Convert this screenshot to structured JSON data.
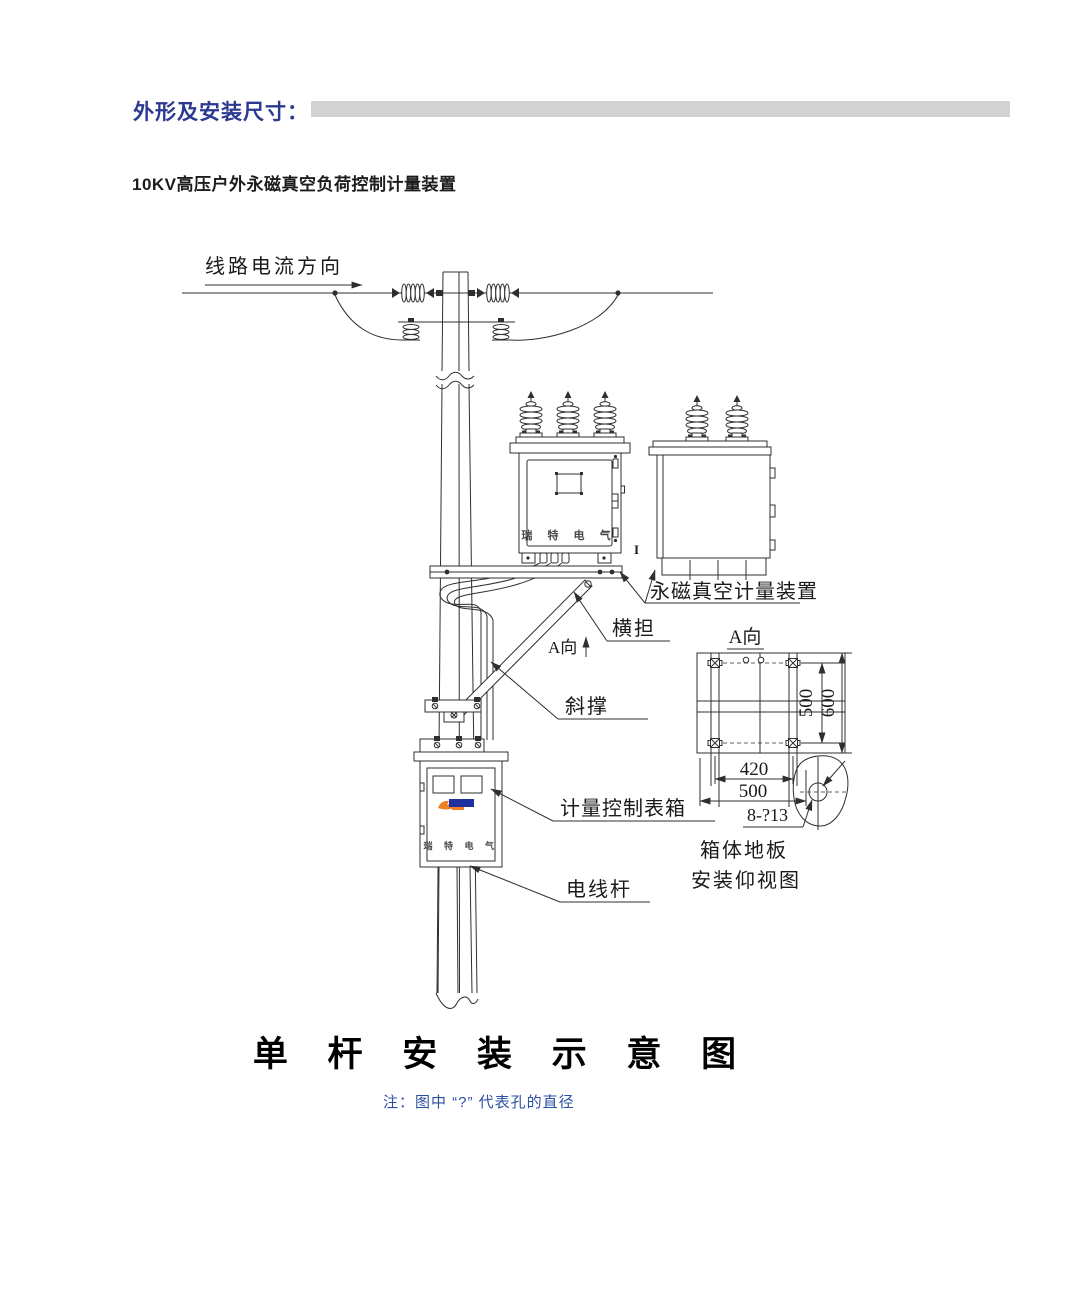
{
  "header": {
    "label": "外形及安装尺寸：",
    "bar_color": "#d2d2d2"
  },
  "subtitle": "10KV高压户外永磁真空负荷控制计量装置",
  "diagram": {
    "labels": {
      "line_current_direction": "线路电流方向",
      "metering_device": "永磁真空计量装置",
      "crossarm": "横担",
      "view_a_marker": "A向",
      "diagonal_brace": "斜撑",
      "meter_control_box": "计量控制表箱",
      "utility_pole": "电线杆",
      "section_mark": "I",
      "brand_front_box": "瑞 特 电 气",
      "brand_meter_box": "瑞 特 电 气"
    },
    "detail_view": {
      "title": "A向",
      "dim_height_inner": "500",
      "dim_height_outer": "600",
      "dim_width_inner": "420",
      "dim_width_outer": "500",
      "holes_label": "8-?13",
      "caption_line1": "箱体地板",
      "caption_line2": "安装仰视图"
    }
  },
  "footer": {
    "main_title": "单 杆 安 装 示 意 图",
    "note": "注：图中 “?” 代表孔的直径"
  }
}
